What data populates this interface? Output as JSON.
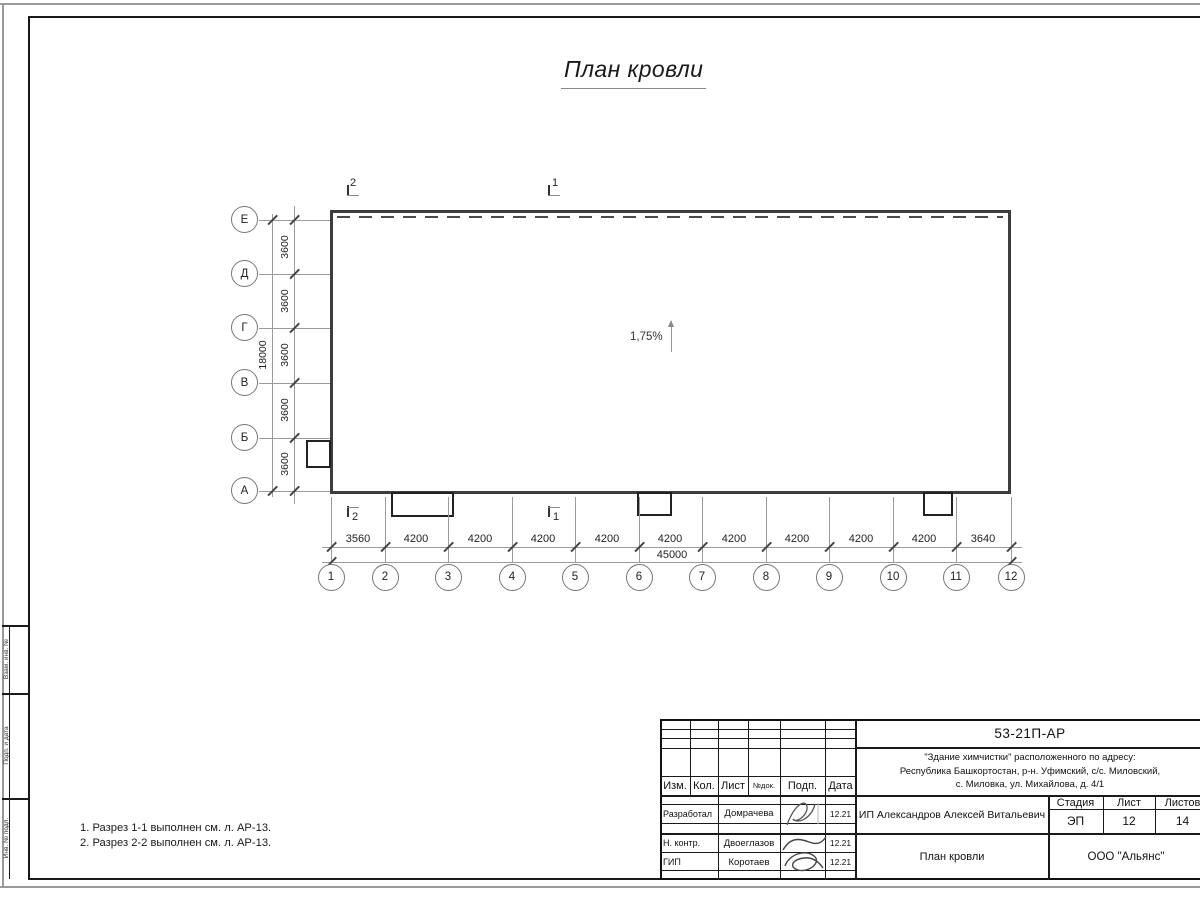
{
  "title": "План кровли",
  "plan": {
    "slope_label": "1,75%",
    "row_axes": [
      "Е",
      "Д",
      "Г",
      "В",
      "Б",
      "А"
    ],
    "row_dims": [
      "3600",
      "3600",
      "3600",
      "3600",
      "3600"
    ],
    "row_total": "18000",
    "col_axes": [
      "1",
      "2",
      "3",
      "4",
      "5",
      "6",
      "7",
      "8",
      "9",
      "10",
      "11",
      "12"
    ],
    "col_dims": [
      "3560",
      "4200",
      "4200",
      "4200",
      "4200",
      "4200",
      "4200",
      "4200",
      "4200",
      "4200",
      "3640"
    ],
    "col_total": "45000",
    "section_top": [
      "2",
      "1"
    ],
    "section_bottom": [
      "2",
      "1"
    ]
  },
  "notes": [
    "1. Разрез 1-1 выполнен см. л. АР-13.",
    "2. Разрез 2-2 выполнен см. л. АР-13."
  ],
  "frame_labels": [
    "Взам. инв. №",
    "Подп. и дата",
    "Инв. № подл."
  ],
  "title_block": {
    "doc_code": "53-21П-АР",
    "address_lines": [
      "\"Здание химчистки\" расположенного по адресу:",
      "Республика Башкортостан, р-н. Уфимский, с/с. Миловский,",
      "с. Миловка, ул. Михайлова, д. 4/1"
    ],
    "header_cols": [
      "Изм.",
      "Кол.",
      "Лист",
      "№док.",
      "Подп.",
      "Дата"
    ],
    "signers": [
      {
        "role": "Разработал",
        "name": "Домрачева",
        "date": "12.21"
      },
      {
        "role": "Н. контр.",
        "name": "Двоеглазов",
        "date": "12.21"
      },
      {
        "role": "ГИП",
        "name": "Коротаев",
        "date": "12.21"
      }
    ],
    "client": "ИП Александров Алексей Витальевич",
    "stage_cols": [
      "Стадия",
      "Лист",
      "Листов"
    ],
    "stage_values": [
      "ЭП",
      "12",
      "14"
    ],
    "sheet_title": "План кровли",
    "company": "ООО \"Альянс\""
  },
  "colors": {
    "frame": "#1a1a1a",
    "plan_outline": "#3d3d3d",
    "thin_line": "#999999",
    "outer_border": "#9a9a9a"
  }
}
